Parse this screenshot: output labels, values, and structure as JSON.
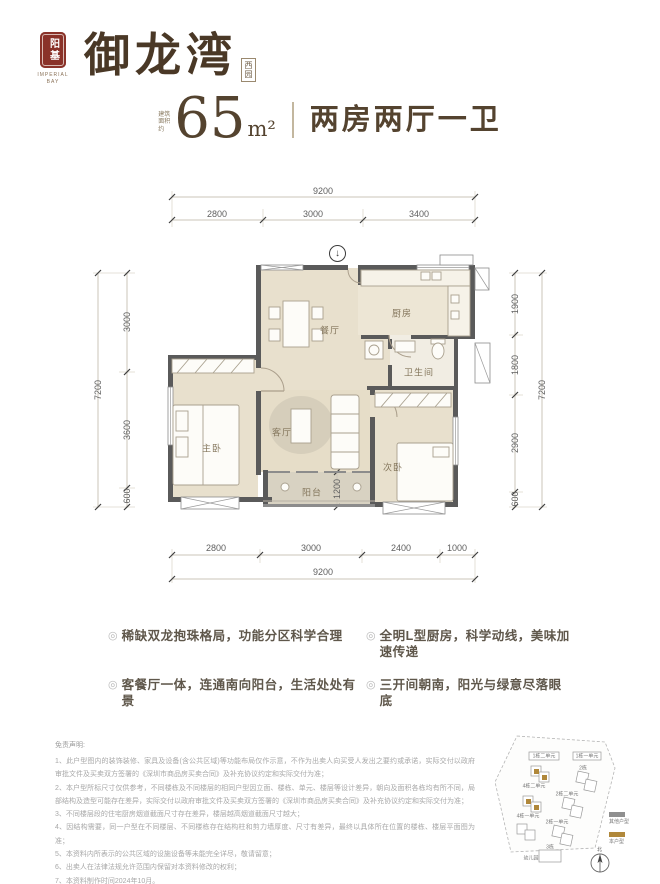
{
  "brand": {
    "seal_text": "阳基",
    "seal_caption": "IMPERIAL BAY",
    "name": "御龙湾",
    "sub_name": "西园"
  },
  "header": {
    "area_label": "建筑面积约",
    "area_value": "65",
    "area_unit": "m²",
    "title": "两房两厅一卫"
  },
  "ui": {
    "bullet": "◎",
    "entry_glyph": "↓"
  },
  "floorplan": {
    "rooms": {
      "dining": "餐厅",
      "kitchen": "厨房",
      "bath": "卫生间",
      "master": "主卧",
      "living": "客厅",
      "second": "次卧",
      "balcony": "阳台"
    },
    "dims": {
      "top_overall": "9200",
      "top_segments": [
        "2800",
        "3000",
        "3400"
      ],
      "left_overall": "7200",
      "left_segments": [
        "3000",
        "3600",
        "600"
      ],
      "right_segments": [
        "1900",
        "1800",
        "2900",
        "600"
      ],
      "right_overall": "7200",
      "bottom_segments": [
        "2800",
        "3000",
        "2400",
        "1000"
      ],
      "bottom_overall": "9200",
      "balcony_depth": "1200"
    }
  },
  "features": [
    "稀缺双龙抱珠格局，功能分区科学合理",
    "全明L型厨房，科学动线，美味加速传递",
    "客餐厅一体，连通南向阳台，生活处处有景",
    "三开间朝南，阳光与绿意尽落眼底"
  ],
  "disclaimer": {
    "title": "免责声明:",
    "items": [
      "1、此户型图内的装饰装修、家具及设备(含公共区域)等功能布局仅作示意，不作为出卖人向买受人发出之要约或承诺，实际交付以政府审批文件及买卖双方签署的《深圳市商品房买卖合同》及补充协议约定和实际交付为准；",
      "2、本户型所标尺寸仅供参考，不同楼栋及不同楼层的相同户型因立面、楼栋、单元、楼层等设计差异，朝向及面积各栋均有所不同，局部结构及造型可能存在差异，实际交付以政府审批文件及买卖双方签署的《深圳市商品房买卖合同》及补充协议约定和实际交付为准；",
      "3、不同楼层段的住宅厨房烟道截面尺寸存在差异，楼层越高烟道截面尺寸越大；",
      "4、因结构需要，同一户型在不同楼层、不同楼栋存在结构柱和剪力墙厚度、尺寸有差异，最终以具体所在位置的楼栋、楼层平面图为准；",
      "5、本资料内所表示的公共区域的设施设备等未能完全详尽，敬请留意；",
      "6、出卖人在法律法规允许范围内保留对本资料修改的权利；",
      "7、本资料制作时间2024年10月。"
    ]
  },
  "siteplan": {
    "buildings": [
      "1栋二单元",
      "1栋一单元",
      "2栋",
      "4栋二单元",
      "2栋二单元",
      "4栋一单元",
      "2栋一单元",
      "3栋",
      "幼儿园"
    ],
    "legend": [
      {
        "label": "其他户型",
        "color": "#8f8f8f"
      },
      {
        "label": "本户型",
        "color": "#b0883b"
      }
    ],
    "compass_label": "北"
  },
  "colors": {
    "brand_brown": "#4a3826",
    "seal_red": "#8a3229",
    "title_brown": "#54432f",
    "wall_gray": "#5a5a5a",
    "room_beige": "#e8e0cd",
    "balcony_gray": "#d8d2c2",
    "accent_gold": "#b0883b",
    "disclaimer_gray": "#a8a8a8"
  }
}
